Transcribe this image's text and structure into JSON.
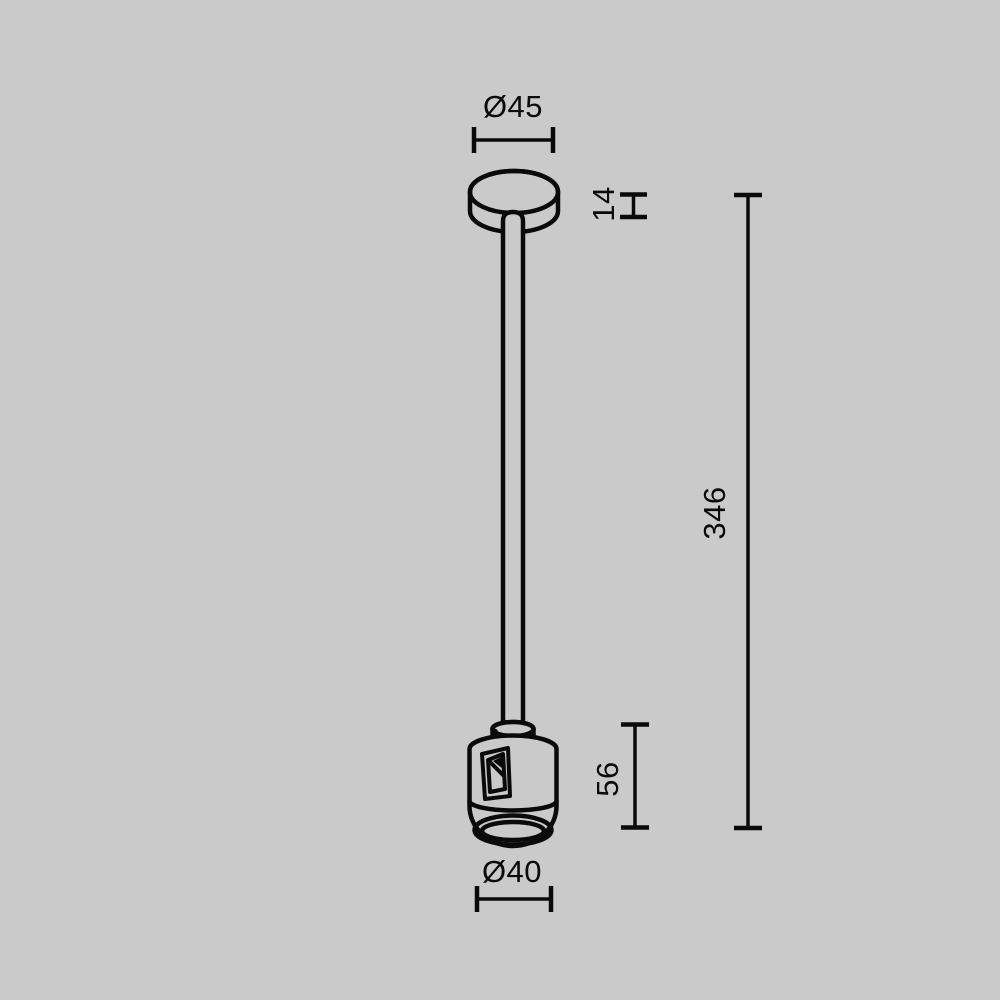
{
  "canvas": {
    "background_color": "#cacaca",
    "line_color": "#0a0a0a"
  },
  "drawing": {
    "kind": "technical dimensional drawing",
    "subject": "ceiling-mount suspension: canopy, drop rod and cylindrical track connector"
  },
  "dimensions": {
    "top_diameter": {
      "label": "Ø45"
    },
    "canopy_height": {
      "label": "14"
    },
    "overall_length": {
      "label": "346"
    },
    "connector_height": {
      "label": "56"
    },
    "bottom_diameter": {
      "label": "Ø40"
    }
  }
}
